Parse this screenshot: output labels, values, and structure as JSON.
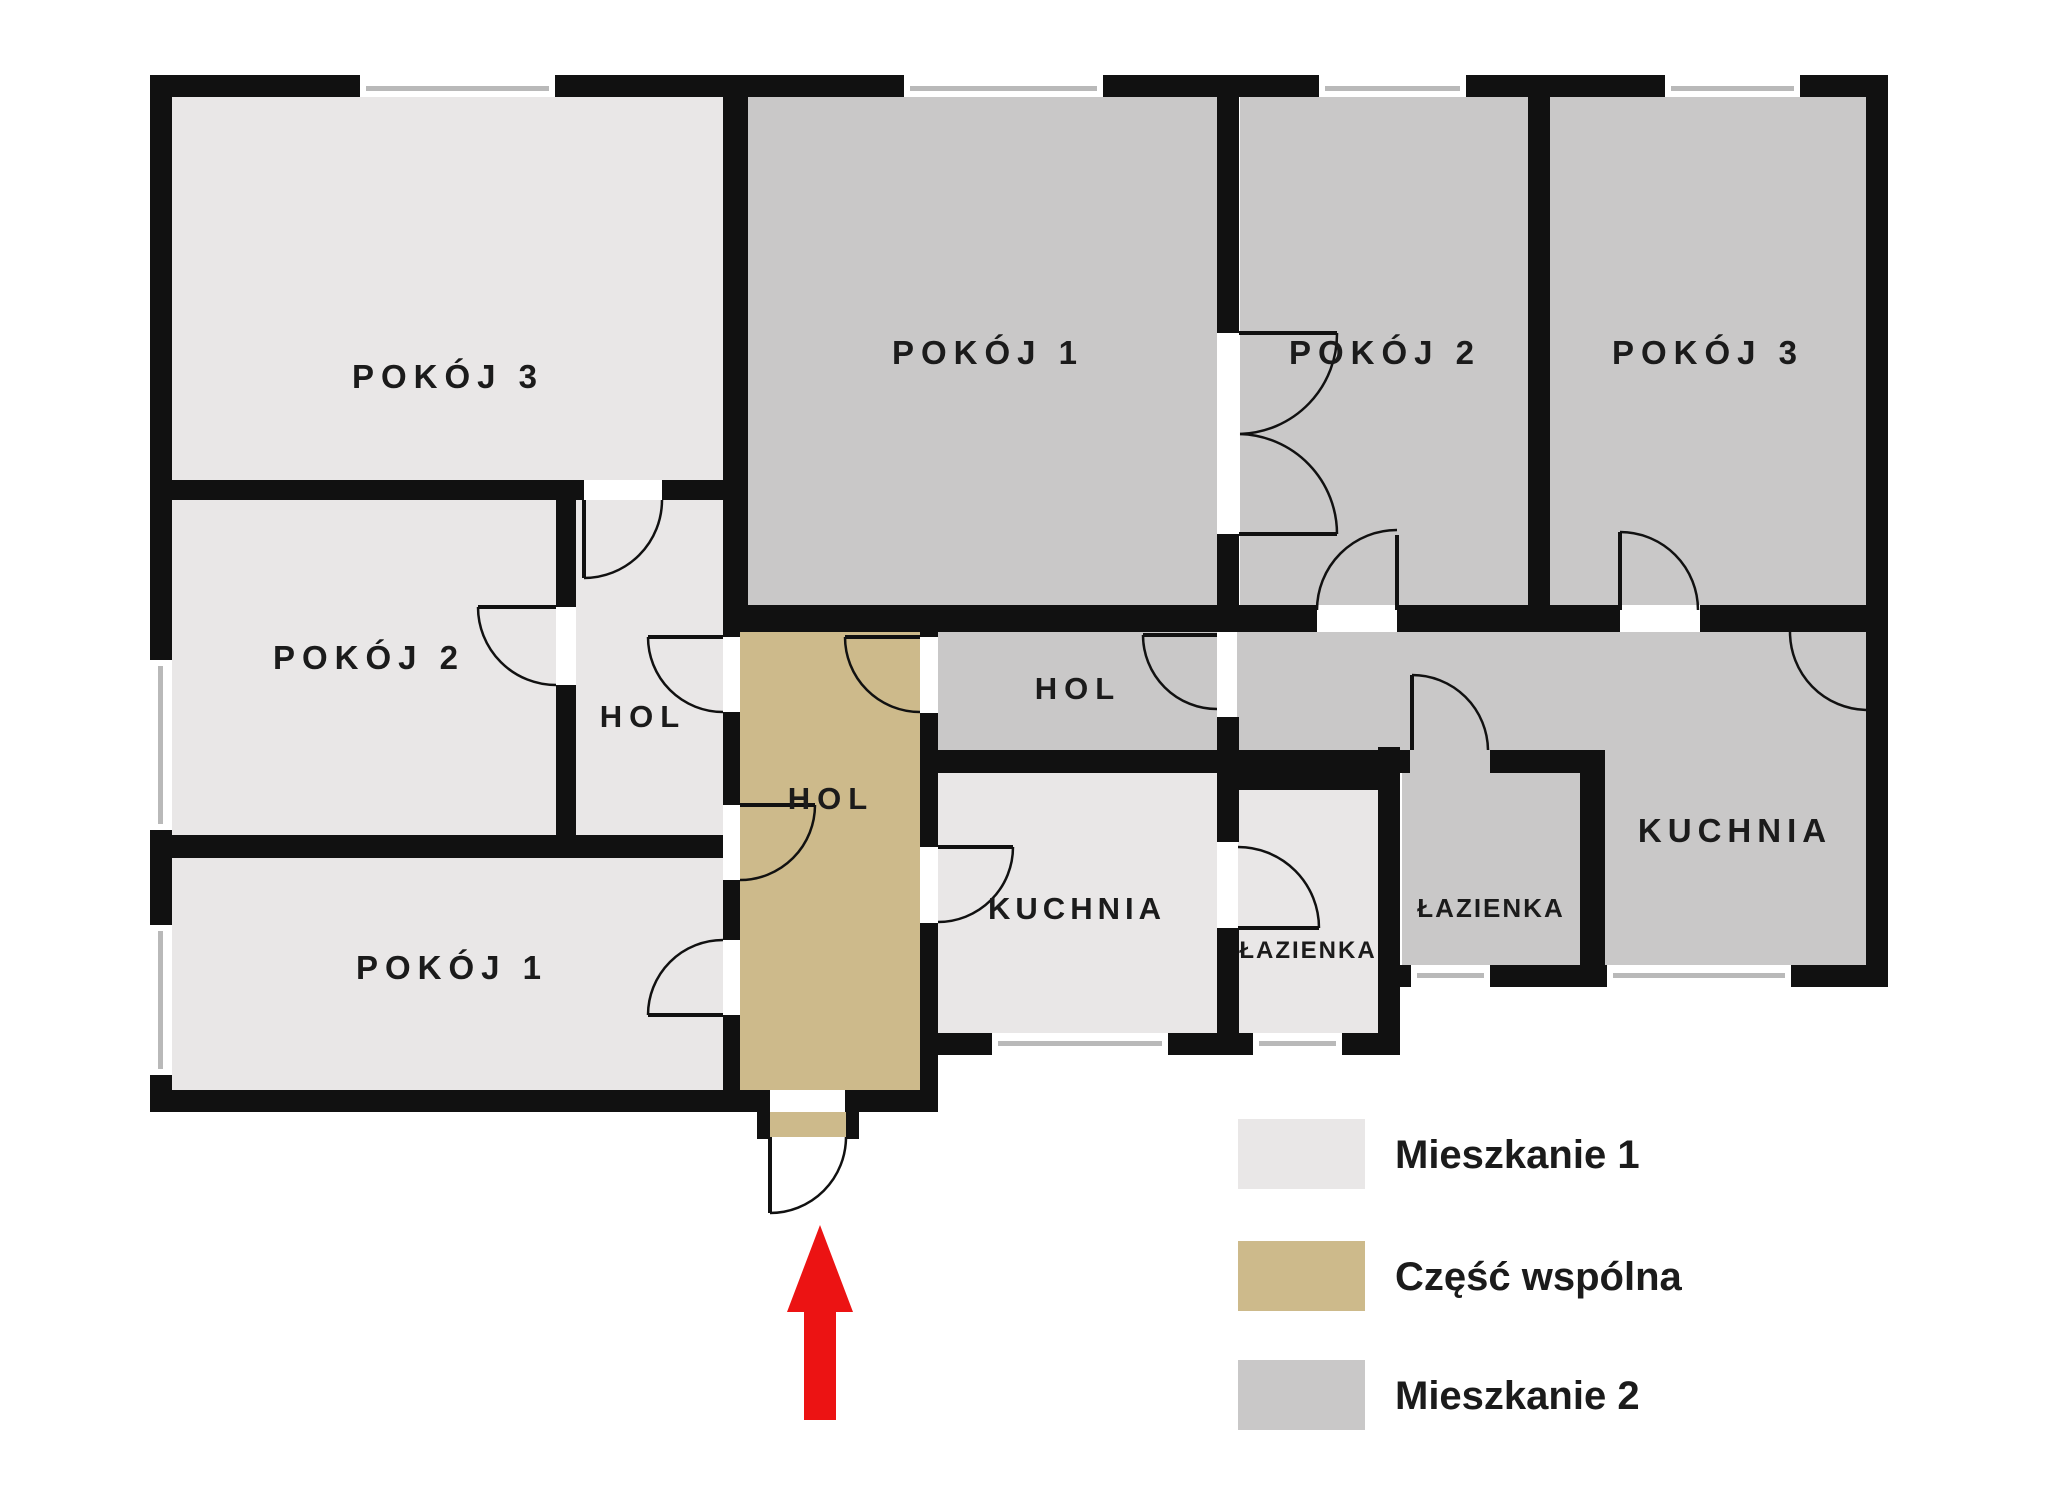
{
  "plan": {
    "title": "Rzut mieszkania",
    "rooms": [
      {
        "key": "m1-pokoj3",
        "label": "POKÓJ 3",
        "apartment": "Mieszkanie 1"
      },
      {
        "key": "m1-pokoj2",
        "label": "POKÓJ 2",
        "apartment": "Mieszkanie 1"
      },
      {
        "key": "m1-hol",
        "label": "HOL",
        "apartment": "Mieszkanie 1"
      },
      {
        "key": "m1-pokoj1",
        "label": "POKÓJ 1",
        "apartment": "Mieszkanie 1"
      },
      {
        "key": "common-hol",
        "label": "HOL",
        "apartment": "Część wspólna"
      },
      {
        "key": "m1-kuchnia",
        "label": "KUCHNIA",
        "apartment": "Mieszkanie 1"
      },
      {
        "key": "m1-lazienka",
        "label": "ŁAZIENKA",
        "apartment": "Mieszkanie 1"
      },
      {
        "key": "m2-pokoj1",
        "label": "POKÓJ 1",
        "apartment": "Mieszkanie 2"
      },
      {
        "key": "m2-pokoj2",
        "label": "POKÓJ 2",
        "apartment": "Mieszkanie 2"
      },
      {
        "key": "m2-pokoj3",
        "label": "POKÓJ 3",
        "apartment": "Mieszkanie 2"
      },
      {
        "key": "m2-hol",
        "label": "HOL",
        "apartment": "Mieszkanie 2"
      },
      {
        "key": "m2-lazienka",
        "label": "ŁAZIENKA",
        "apartment": "Mieszkanie 2"
      },
      {
        "key": "m2-kuchnia",
        "label": "KUCHNIA",
        "apartment": "Mieszkanie 2"
      }
    ]
  },
  "legend": {
    "items": [
      {
        "label": "Mieszkanie 1",
        "color": "#E9E7E7"
      },
      {
        "label": "Część wspólna",
        "color": "#CDBA8B"
      },
      {
        "label": "Mieszkanie 2",
        "color": "#C9C8C8"
      }
    ]
  },
  "colors": {
    "m1": "#E9E7E7",
    "common": "#CDBA8B",
    "m2": "#C9C8C8",
    "wall": "#111111",
    "window_line": "#B9B9B9",
    "arrow": "#EC1313",
    "background": "#FFFFFF"
  },
  "icons": {
    "entrance_arrow": "red-up-arrow"
  }
}
